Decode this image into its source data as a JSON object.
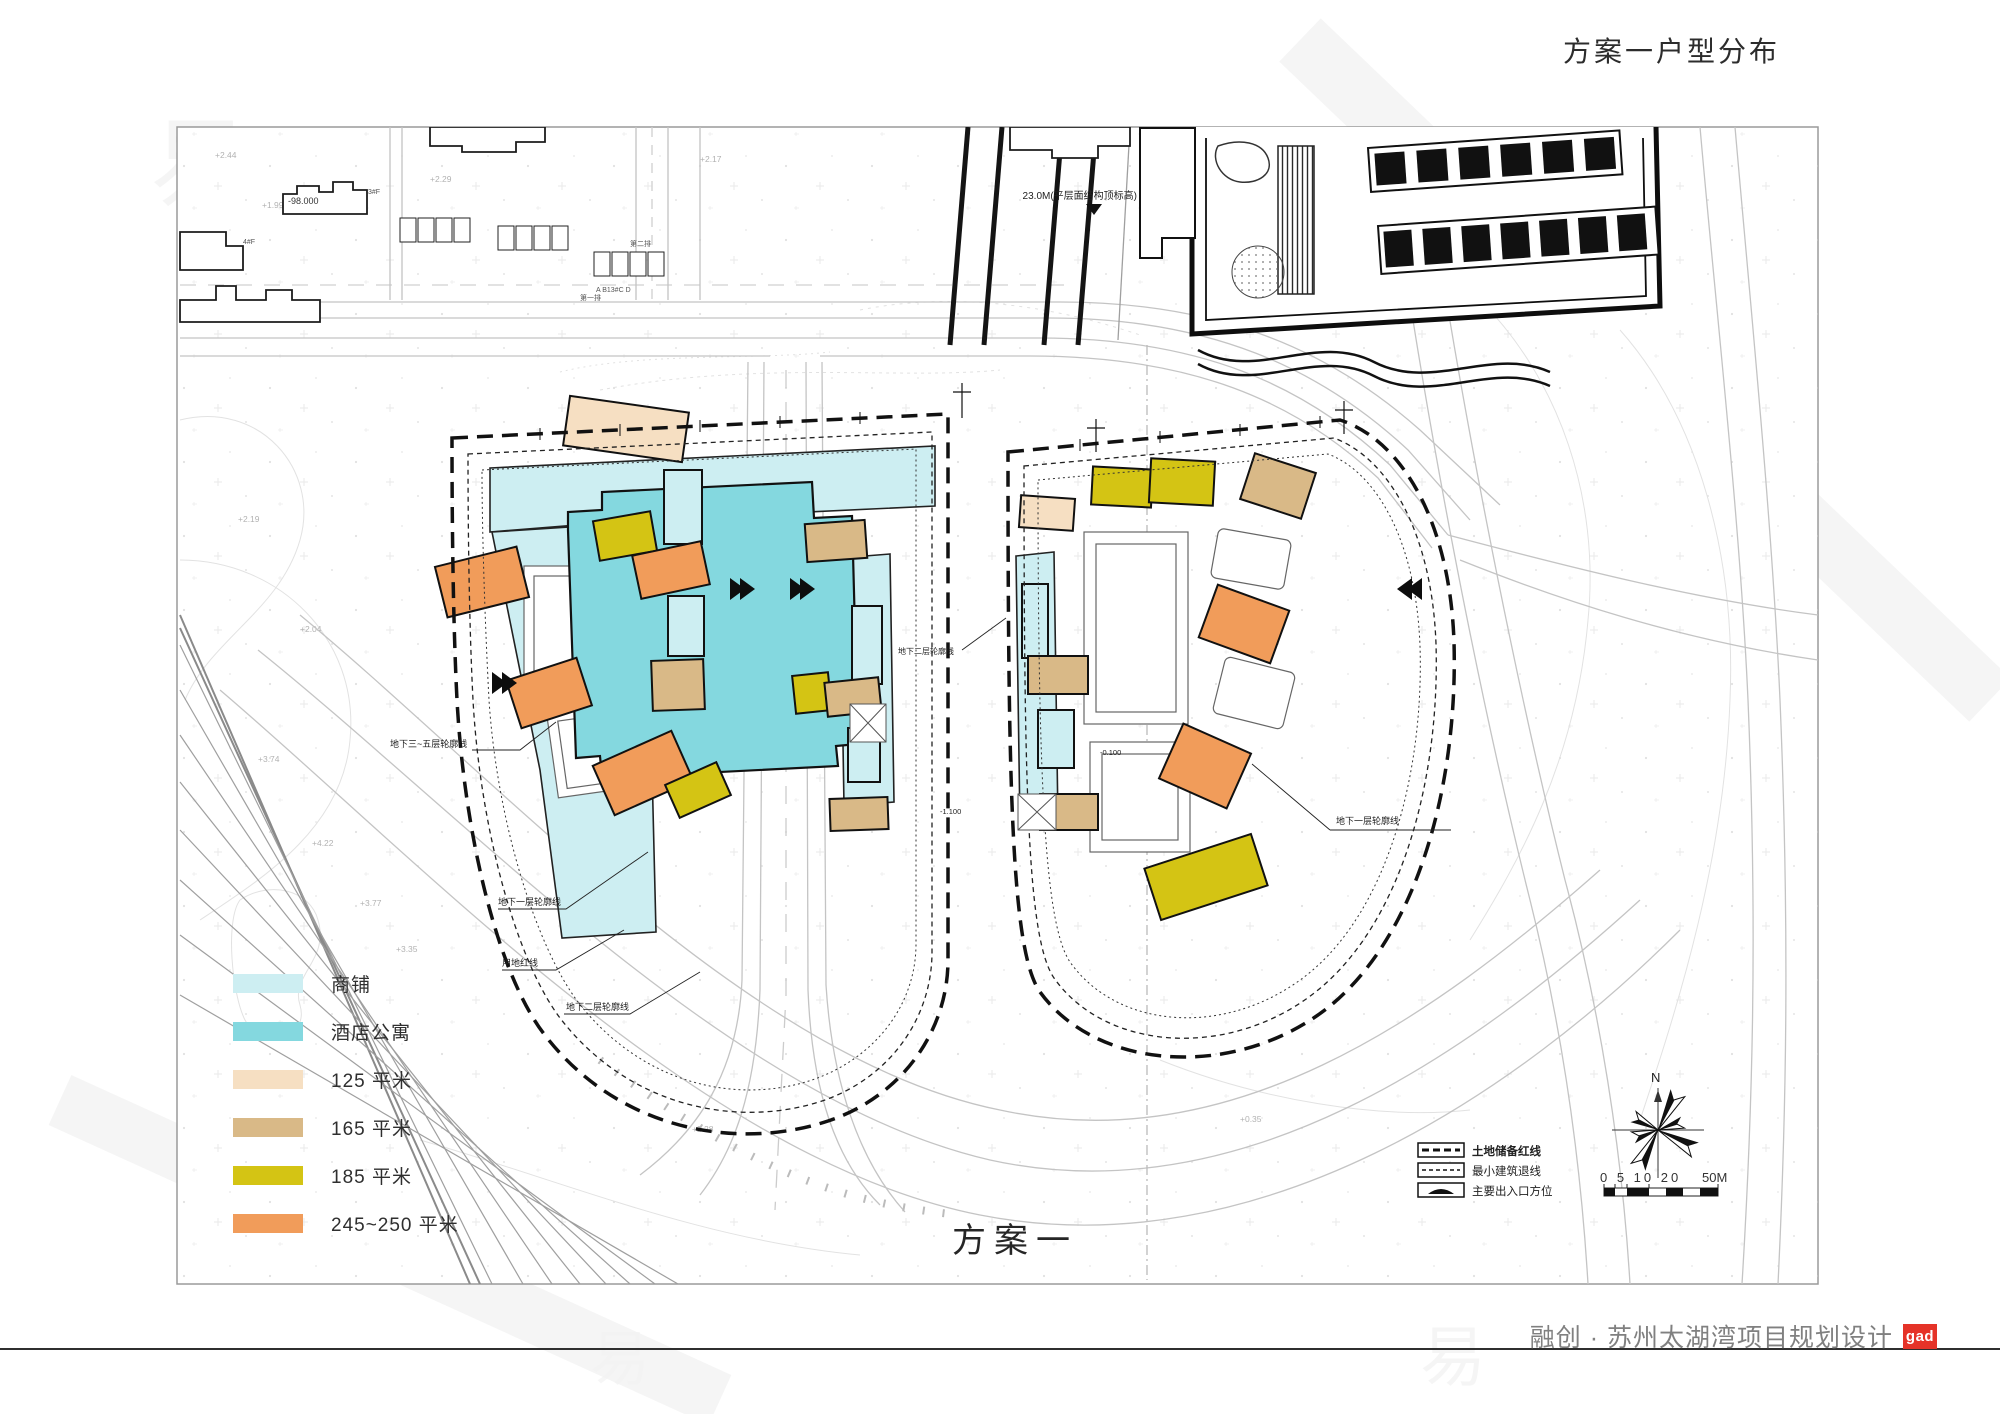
{
  "page": {
    "title": "方案一户型分布",
    "plan_label": "方案一"
  },
  "footer": {
    "project": "融创 · 苏州太湖湾项目规划设计",
    "logo": "gad"
  },
  "legend": {
    "items": [
      {
        "label": "商铺",
        "color": "#cdeef2"
      },
      {
        "label": "酒店公寓",
        "color": "#84d8df"
      },
      {
        "label": "125 平米",
        "color": "#f6dfc2"
      },
      {
        "label": "165 平米",
        "color": "#d9b987"
      },
      {
        "label": "185 平米",
        "color": "#d4c414"
      },
      {
        "label": "245~250 平米",
        "color": "#f19c5a"
      }
    ]
  },
  "map_legend": {
    "items": [
      {
        "label": "土地储备红线",
        "symbol": "bold-dashed-line-icon"
      },
      {
        "label": "最小建筑退线",
        "symbol": "fine-dashed-line-icon"
      },
      {
        "label": "主要出入口方位",
        "symbol": "entrance-arrow-icon"
      }
    ],
    "compass_label": "N",
    "scale_ticks": "0 5 10 20",
    "scale_end": "50M"
  },
  "annotations": {
    "b35_left": "地下三~五层轮廓线",
    "b1_left": "地下一层轮廓线",
    "red_line": "用地红线",
    "b2_left": "地下二层轮廓线",
    "b2_mid": "地下二层轮廓线",
    "b1_right": "地下一层轮廓线",
    "roof_note": "23.0M(平层面结构顶标高)",
    "elev_bldg": "-98.000",
    "level_a": "-0.100",
    "level_b": "-1.100"
  },
  "map": {
    "micro_labels": {
      "row1": "第一排",
      "row2": "第二排",
      "abc": "A B13#C D",
      "f3": "3#F",
      "f4": "4#F"
    },
    "spot_elevations": [
      "+2.44",
      "+1.99",
      "+2.29",
      "+2.17",
      "+2.19",
      "+3.74",
      "+4.22",
      "+3.77",
      "+3.35",
      "+2.28",
      "+2.04",
      "+0.35"
    ]
  },
  "colors": {
    "shop": "#cdeef2",
    "hotel": "#84d8df",
    "a125": "#f6dfc2",
    "a165": "#d9b987",
    "a185": "#d4c414",
    "a245": "#f19c5a",
    "boundary": "#111111",
    "road": "#c4c4c4",
    "contour": "#e2e2e2",
    "accent_red": "#e53328"
  }
}
